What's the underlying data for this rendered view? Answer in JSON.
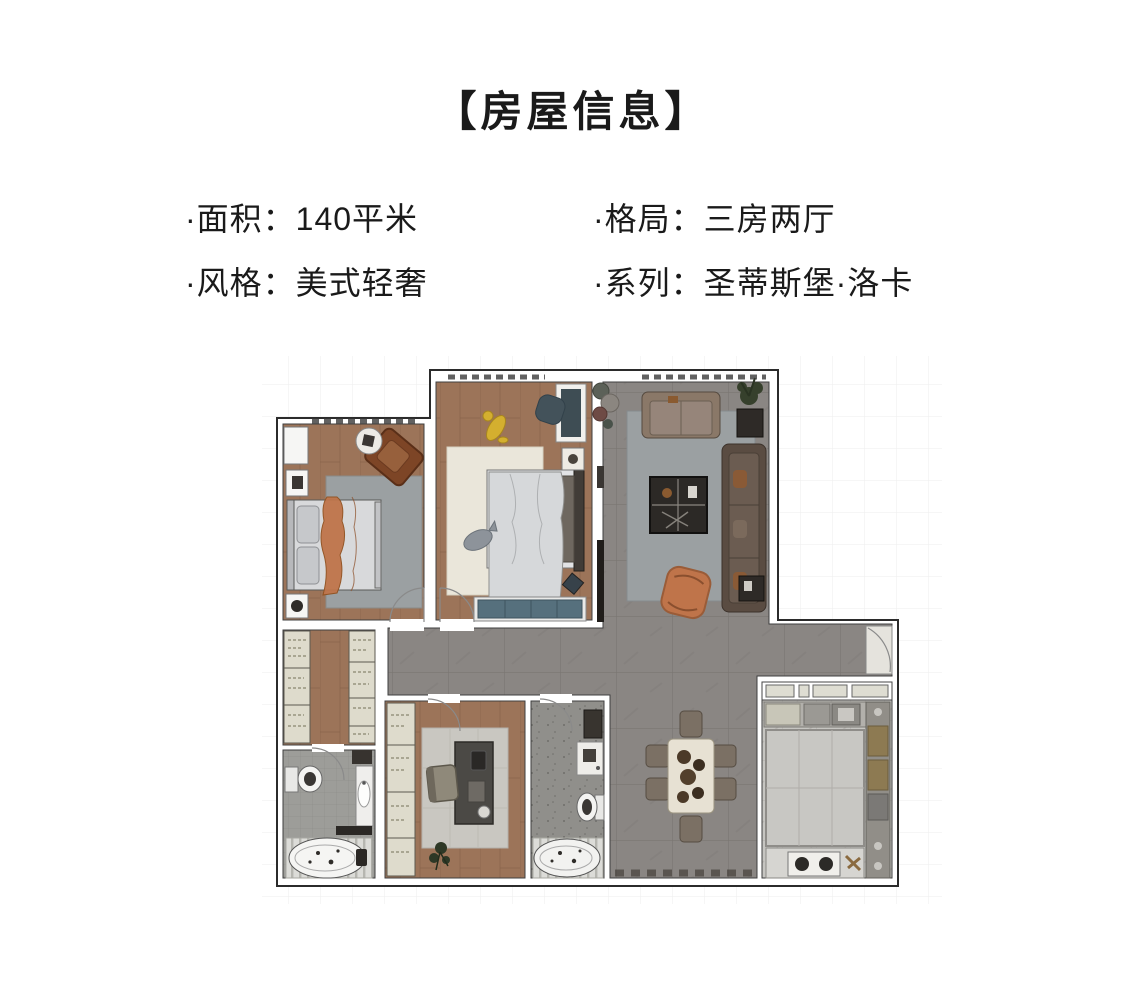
{
  "header": {
    "title": "【房屋信息】"
  },
  "info": {
    "area": "·面积：140平米",
    "layout": "·格局：三房两厅",
    "style": "·风格：美式轻奢",
    "series": "·系列：圣蒂斯堡·洛卡"
  },
  "colors": {
    "text": "#1a1a1a",
    "wood": "#9c7459",
    "wood-dark": "#7f5c44",
    "tile": "#8a8683",
    "tile-dark": "#797572",
    "rug-gray": "#9ba0a2",
    "rug-cream": "#eae6da",
    "sofa-tan": "#8a7868",
    "sofa-dark": "#5a4c42",
    "accent-orange": "#bf744a",
    "cabinet": "#dedbcc",
    "teal": "#56707d",
    "bath-tile": "#9d9d99",
    "kitchen-floor": "#c6c5c1"
  }
}
